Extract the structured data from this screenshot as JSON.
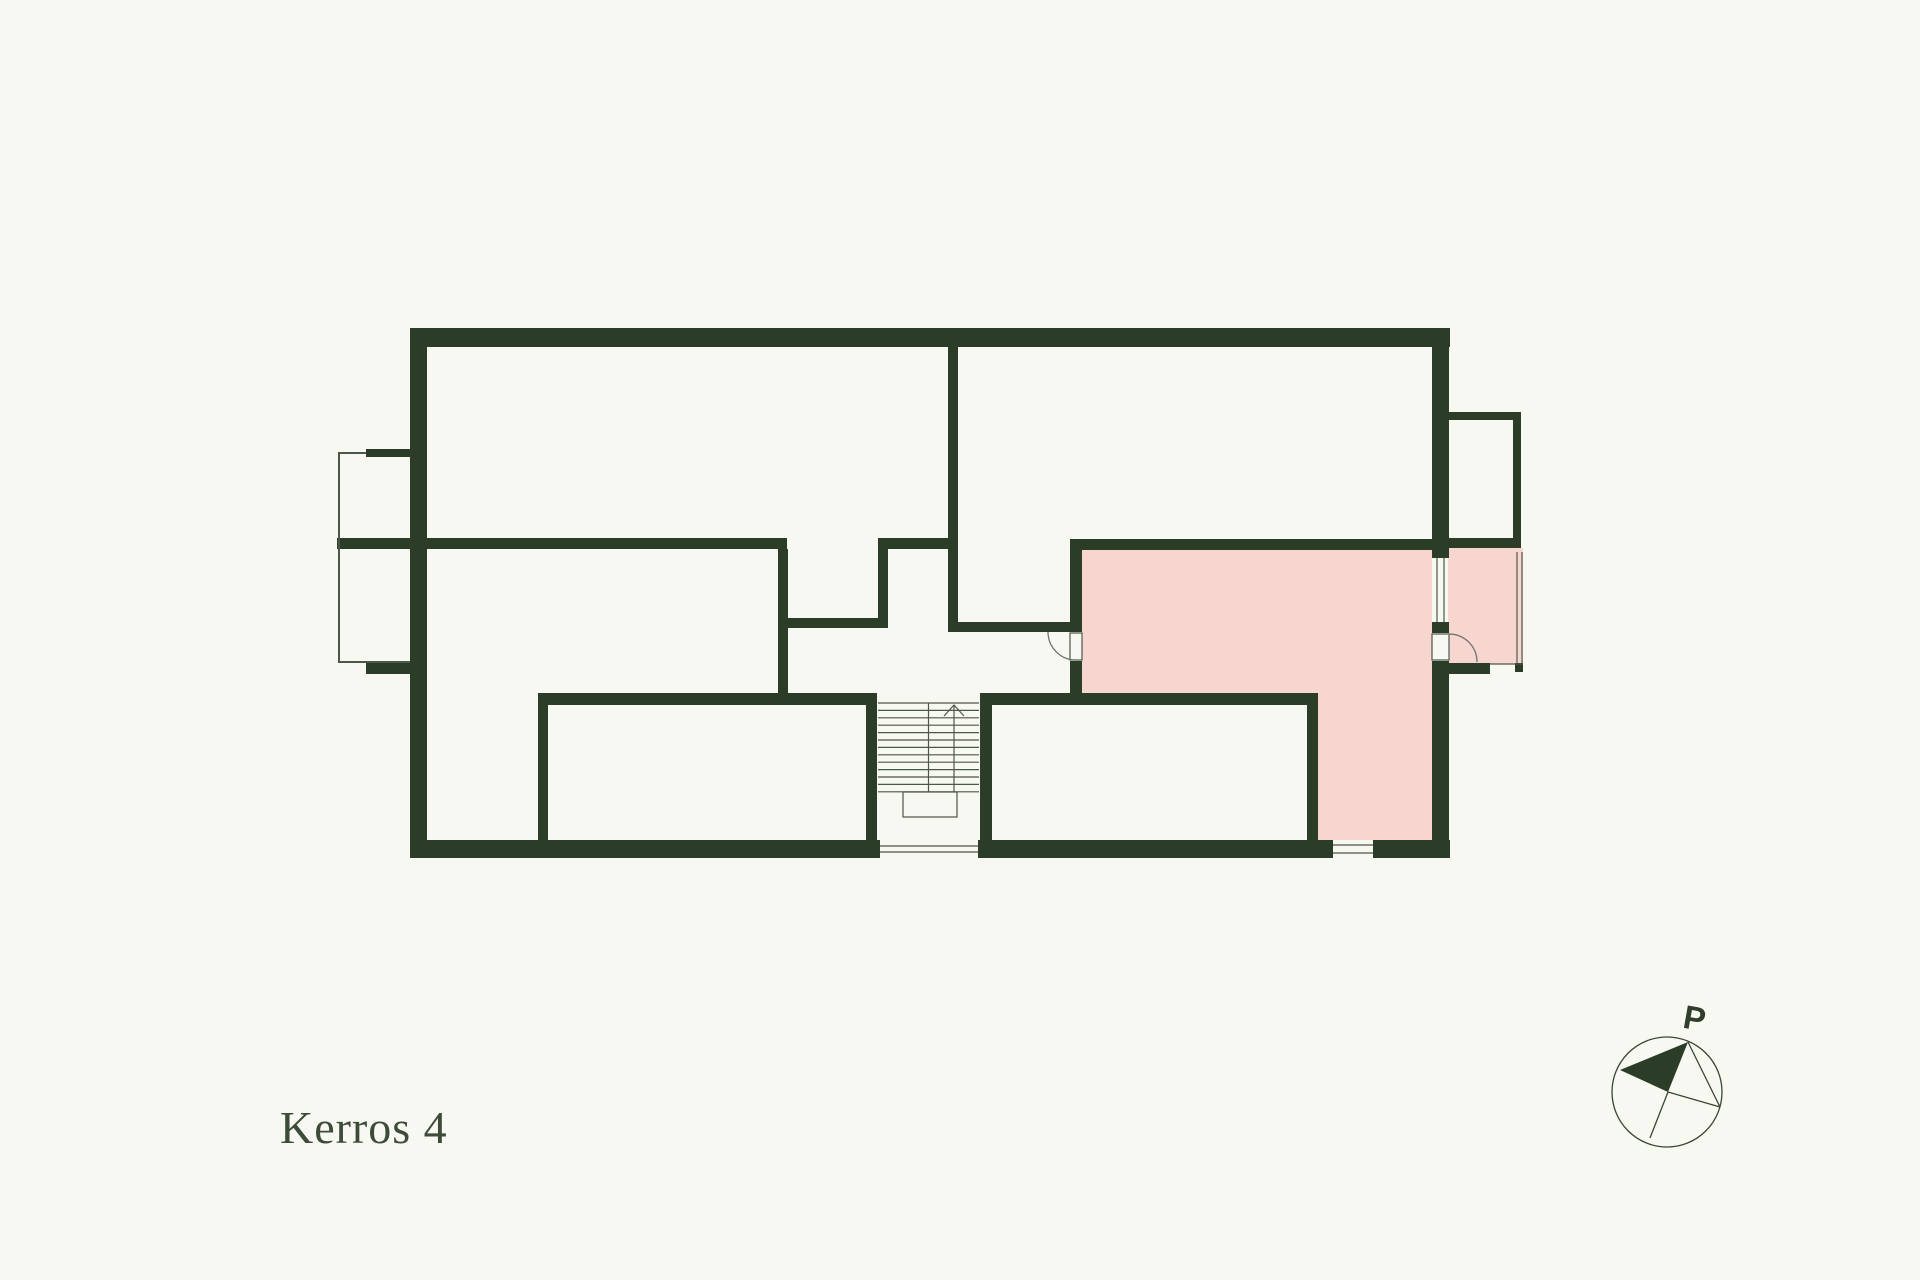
{
  "floor_label": "Kerros 4",
  "compass": {
    "north_label": "P"
  },
  "colors": {
    "background": "#f7f8f1",
    "wall": "#2c3d27",
    "highlight_room": "#f8d6d0",
    "thin_line": "#4c564a",
    "text": "#3d4b39"
  }
}
